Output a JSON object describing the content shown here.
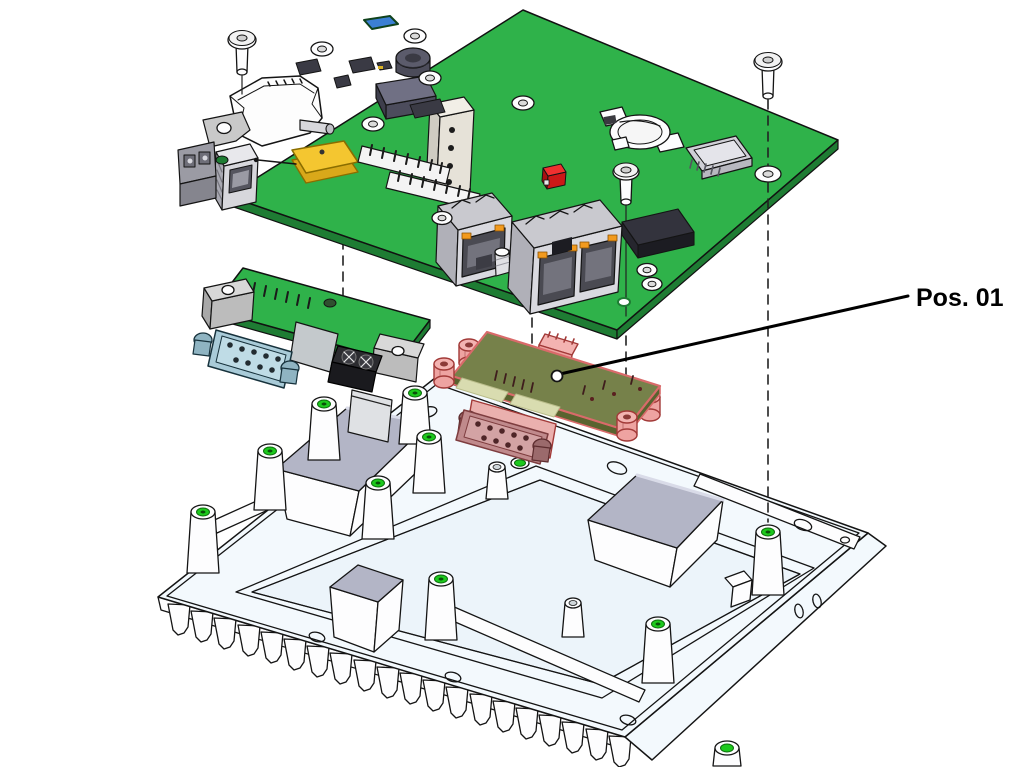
{
  "figure": {
    "type": "exploded-assembly-technical-drawing",
    "background": "#ffffff",
    "callout": {
      "label": "Pos. 01",
      "target_part": "highlighted-io-module"
    },
    "colors": {
      "pcb_green": "#2fb24a",
      "highlight_pink": "#f2a7a5",
      "chassis_white": "#f3f9fd",
      "thermal_pad_gray": "#b3b5c6",
      "antenna_yellow": "#f4c630",
      "component_red": "#e22222",
      "post_hole_green": "#1dc91d",
      "db9_teal": "#a9cbd8"
    },
    "parts": [
      "main-pcb",
      "serial-daughterboard",
      "highlighted-io-module",
      "heatsink-chassis",
      "mounting-screws",
      "coin-cell-battery-holder",
      "micro-sd-slot",
      "rj45-connectors",
      "db9-connectors",
      "gps-antenna",
      "usb-connector",
      "fiber-lc-connector",
      "terminal-block",
      "buzzer"
    ]
  }
}
